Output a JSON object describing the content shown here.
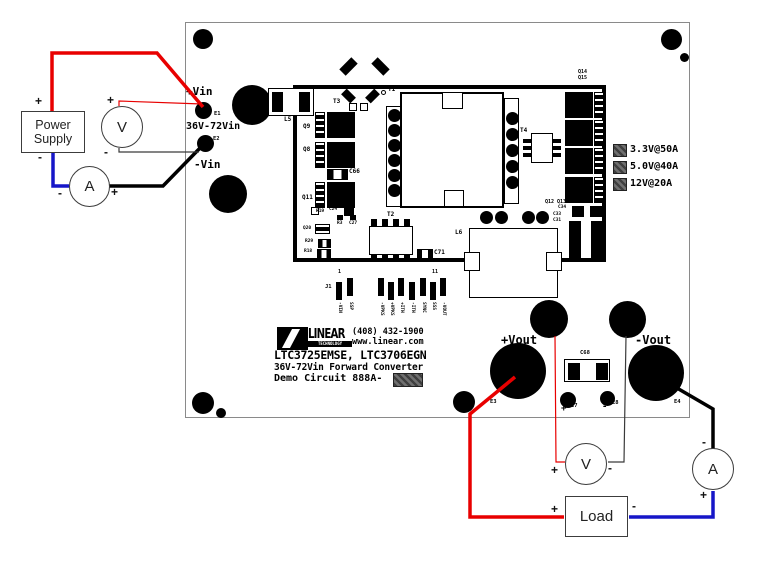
{
  "symbols": {
    "plus": "+",
    "minus": "-"
  },
  "instruments": {
    "power_supply": {
      "line1": "Power",
      "line2": "Supply"
    },
    "voltmeter": "V",
    "ammeter": "A",
    "load": "Load"
  },
  "board": {
    "input": {
      "vin_plus": "+Vin",
      "e1": "E1",
      "range": "36V-72Vin",
      "e2": "E2",
      "vin_minus": "-Vin"
    },
    "output": {
      "vout_plus": "+Vout",
      "vout_minus": "-Vout",
      "e3": "E3",
      "e4": "E4",
      "e7": "E7",
      "e8": "E8",
      "c68": "C68"
    },
    "ratings": [
      "3.3V@50A",
      "5.0V@40A",
      "12V@20A"
    ],
    "branding": {
      "logo_main": "LINEAR",
      "logo_sub": "TECHNOLOGY",
      "phone": "(408) 432-1900",
      "website": "www.linear.com",
      "part_numbers": "LTC3725EMSE, LTC3706EGN",
      "description": "36V-72Vin Forward Converter",
      "demo_label": "Demo Circuit 888A-"
    },
    "refdes": {
      "l5": "L5",
      "t3": "T3",
      "t1": "T1",
      "t2": "T2",
      "t4": "T4",
      "q9": "Q9",
      "q8": "Q8",
      "q11": "Q11",
      "c66": "C66",
      "r19": "R19",
      "c24": "C24",
      "q20": "Q20",
      "r3": "R3",
      "c27": "C27",
      "r29": "R29",
      "r18": "R18",
      "c71": "C71",
      "q14": "Q14",
      "q15": "Q15",
      "q12_q13": "Q12 Q13",
      "c34": "C34",
      "c33": "C33",
      "c31": "C31",
      "l6": "L6",
      "j1": "J1",
      "pin_first": "1",
      "pin_last": "11"
    },
    "j1_pins": [
      "-VIN",
      "SSP",
      "-VPKS",
      "+VPKS",
      "+ITH",
      "-ITH",
      "SYNC",
      "SSS",
      "-VOUT"
    ]
  },
  "colors": {
    "positive_wire": "#e80000",
    "negative_supply_wire": "#1616c8",
    "return_wire": "#000000",
    "sense_wire_dark": "#3a3a3a"
  }
}
